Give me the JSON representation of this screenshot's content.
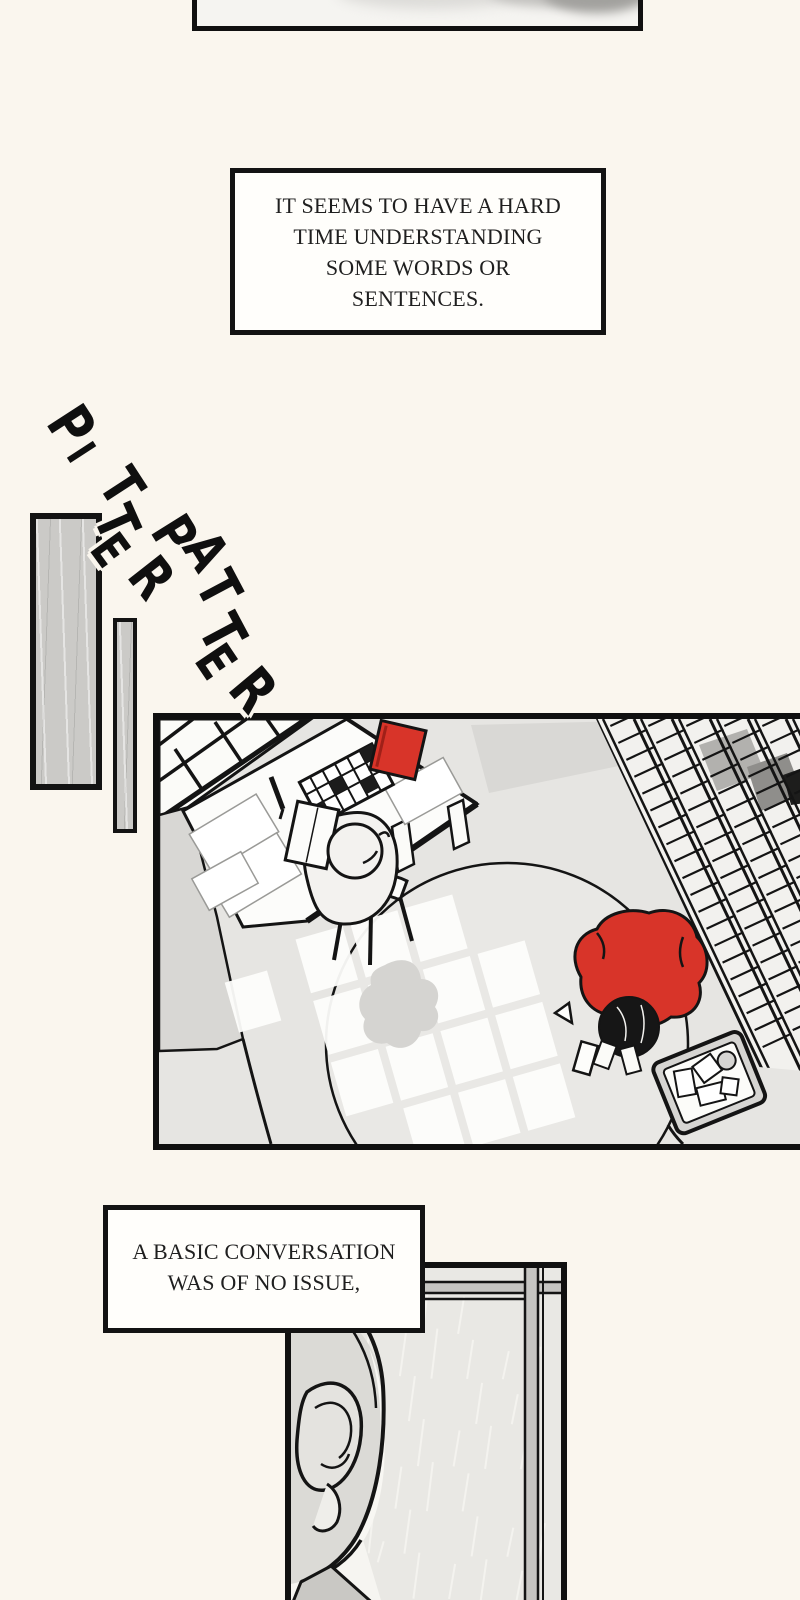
{
  "comic": {
    "caption_1": {
      "lines": [
        "IT SEEMS TO HAVE A HARD",
        "TIME UNDERSTANDING",
        "SOME WORDS OR",
        "SENTENCES."
      ],
      "text": "IT SEEMS TO HAVE A HARD TIME UNDERSTANDING SOME WORDS OR SENTENCES."
    },
    "caption_2": {
      "lines": [
        "A BASIC CONVERSATION",
        "WAS OF NO ISSUE,"
      ],
      "text": "A BASIC CONVERSATION WAS OF NO ISSUE,"
    },
    "sfx": {
      "words": [
        {
          "text": "PITTER",
          "letters": [
            {
              "ch": "P",
              "x": 71,
              "y": 426,
              "r": 57,
              "s": 50
            },
            {
              "ch": "I",
              "x": 80,
              "y": 453,
              "r": 57,
              "s": 36
            },
            {
              "ch": "T",
              "x": 121,
              "y": 487,
              "r": 57,
              "s": 48
            },
            {
              "ch": "T",
              "x": 116,
              "y": 523,
              "r": 66,
              "s": 48
            },
            {
              "ch": "E",
              "x": 110,
              "y": 550,
              "r": 54,
              "s": 42
            },
            {
              "ch": "R",
              "x": 151,
              "y": 578,
              "r": 52,
              "s": 48
            }
          ]
        },
        {
          "text": "PATTER",
          "letters": [
            {
              "ch": "P",
              "x": 174,
              "y": 535,
              "r": 58,
              "s": 48
            },
            {
              "ch": "A",
              "x": 206,
              "y": 551,
              "r": 58,
              "s": 46
            },
            {
              "ch": "T",
              "x": 218,
              "y": 589,
              "r": 62,
              "s": 48
            },
            {
              "ch": "T",
              "x": 222,
              "y": 633,
              "r": 62,
              "s": 50
            },
            {
              "ch": "E",
              "x": 215,
              "y": 662,
              "r": 56,
              "s": 44
            },
            {
              "ch": "R",
              "x": 253,
              "y": 690,
              "r": 50,
              "s": 50
            }
          ]
        }
      ]
    }
  },
  "colors": {
    "page_bg": "#faf6ee",
    "panel_border": "#101010",
    "caption_bg": "#fffefb",
    "caption_text": "#1f1f1f",
    "plank_gray": "#cbcac7",
    "floor_gray": "#e6e5e2",
    "accent_red": "#d83429",
    "hair_black": "#161616",
    "sfx_ink": "#0f0f0f"
  }
}
